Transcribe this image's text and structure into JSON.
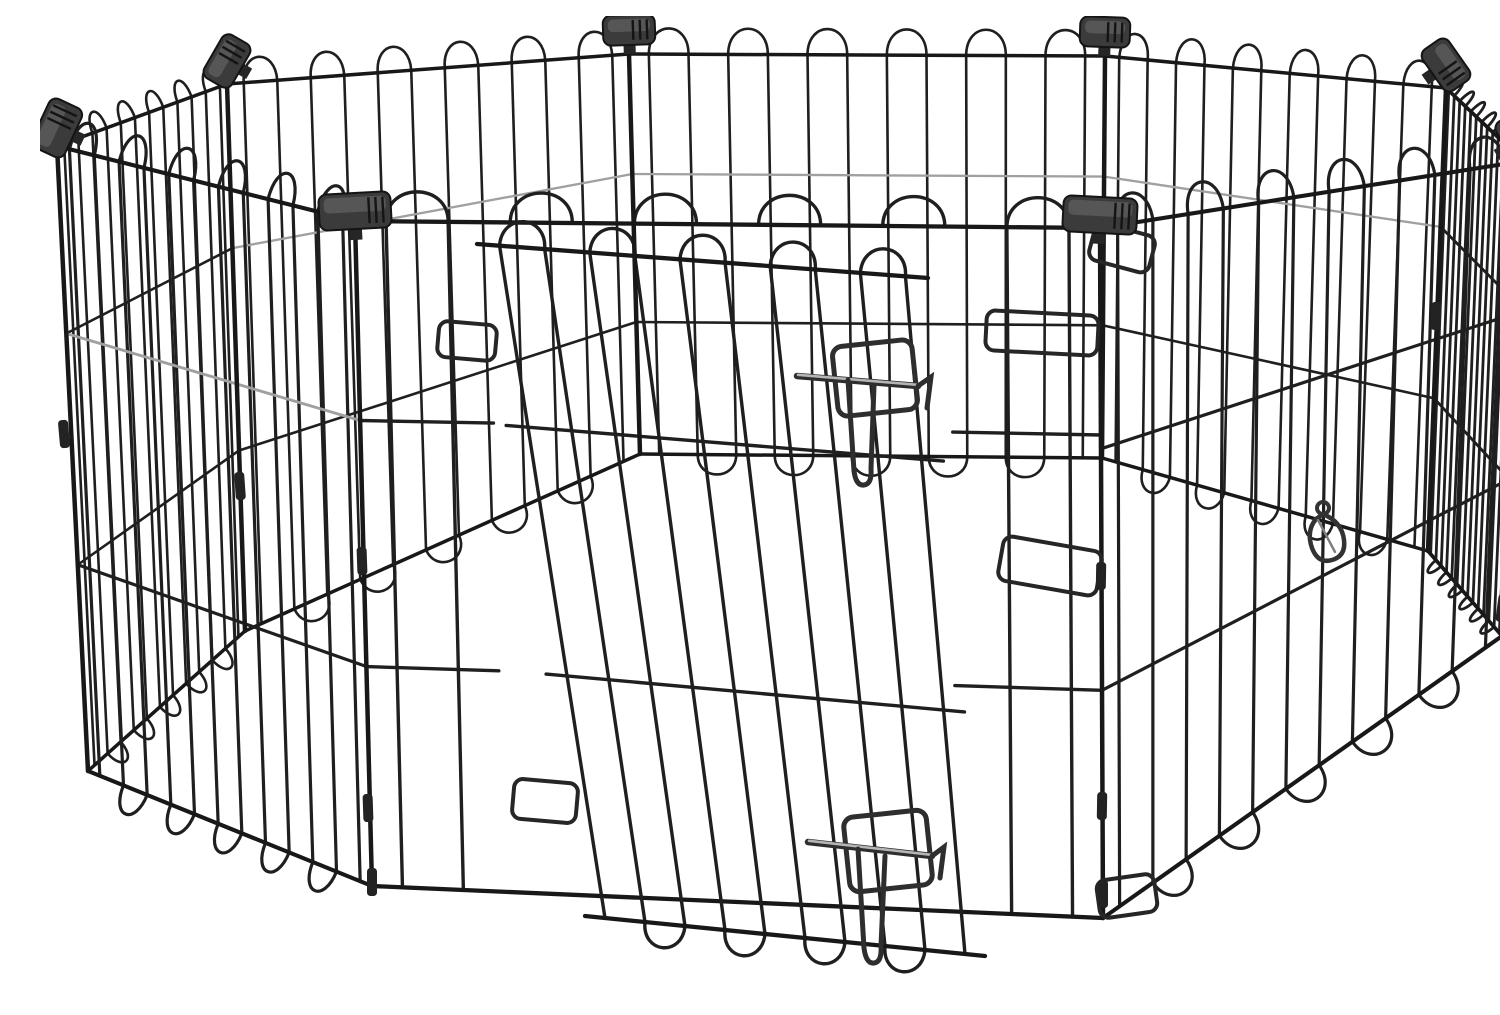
{
  "scene": {
    "subject": "black metal wire 8-panel octagonal pet exercise playpen with latched door",
    "background": "#ffffff",
    "canvas": {
      "width": 1500,
      "height": 983
    }
  },
  "palette": {
    "wire_dark": "#1f1f1f",
    "wire_frame": "#181818",
    "wire_light": "#a0a0a0",
    "latch_metal": "#2e2e2e",
    "latch_shine": "#b5b5b5",
    "connector_body": "#3b3b3b",
    "connector_face": "#5a5a5a",
    "connector_edge": "#141414",
    "clip_fill": "#232323"
  },
  "pen": {
    "panel_count": 8,
    "panels": [
      {
        "name": "back-center-panel",
        "quad": [
          [
            589,
            38
          ],
          [
            1065,
            40
          ],
          [
            1062,
            442
          ],
          [
            600,
            438
          ]
        ],
        "wires": 12,
        "arch": 26,
        "loop": 20,
        "stroke": 2.6,
        "h_wires": [
          {
            "t": 0.3,
            "tone": "light"
          },
          {
            "t": 0.67,
            "tone": "dark"
          }
        ]
      },
      {
        "name": "back-left-panel",
        "quad": [
          [
            187,
            68
          ],
          [
            589,
            38
          ],
          [
            600,
            438
          ],
          [
            205,
            615
          ]
        ],
        "wires": 12,
        "arch": 25,
        "loop": 20,
        "stroke": 2.6,
        "h_wires": [
          {
            "t": 0.3,
            "tone": "light"
          },
          {
            "t": 0.67,
            "tone": "dark"
          }
        ]
      },
      {
        "name": "back-right-panel",
        "quad": [
          [
            1065,
            40
          ],
          [
            1406,
            72
          ],
          [
            1388,
            535
          ],
          [
            1062,
            442
          ]
        ],
        "wires": 12,
        "arch": 25,
        "loop": 20,
        "stroke": 2.6,
        "h_wires": [
          {
            "t": 0.3,
            "tone": "light"
          },
          {
            "t": 0.67,
            "tone": "dark"
          }
        ]
      },
      {
        "name": "left-corner-panel",
        "quad": [
          [
            17,
            130
          ],
          [
            187,
            68
          ],
          [
            205,
            615
          ],
          [
            48,
            755
          ]
        ],
        "wires": 12,
        "arch": 20,
        "loop": 18,
        "stroke": 2.6,
        "h_wires": [
          {
            "t": 0.3,
            "tone": "dark"
          },
          {
            "t": 0.67,
            "tone": "dark"
          }
        ]
      },
      {
        "name": "right-corner-panel",
        "quad": [
          [
            1406,
            72
          ],
          [
            1483,
            145
          ],
          [
            1462,
            620
          ],
          [
            1388,
            535
          ]
        ],
        "wires": 14,
        "arch": 16,
        "loop": 14,
        "stroke": 2.8,
        "h_wires": [
          {
            "t": 0.3,
            "tone": "dark"
          },
          {
            "t": 0.67,
            "tone": "dark"
          }
        ]
      },
      {
        "name": "left-front-panel",
        "quad": [
          [
            17,
            130
          ],
          [
            315,
            205
          ],
          [
            332,
            870
          ],
          [
            48,
            755
          ]
        ],
        "wires": 12,
        "arch": 30,
        "loop": 26,
        "stroke": 3.2,
        "h_wires": [
          {
            "t": 0.3,
            "tone": "light"
          },
          {
            "t": 0.67,
            "tone": "dark"
          }
        ]
      },
      {
        "name": "right-front-panel",
        "quad": [
          [
            1060,
            212
          ],
          [
            1483,
            145
          ],
          [
            1462,
            620
          ],
          [
            1063,
            902
          ]
        ],
        "wires": 12,
        "arch": 30,
        "loop": 26,
        "stroke": 3.2,
        "h_wires": [
          {
            "t": 0.32,
            "tone": "dark"
          },
          {
            "t": 0.67,
            "tone": "dark"
          }
        ]
      },
      {
        "name": "front-door-panel",
        "quad": [
          [
            315,
            205
          ],
          [
            1060,
            212
          ],
          [
            1063,
            902
          ],
          [
            332,
            870
          ]
        ],
        "wires": 12,
        "arch": 30,
        "loop": 26,
        "stroke": 3.4,
        "sections": [
          [
            0,
            0.18
          ],
          [
            0.8,
            1
          ]
        ],
        "h_wires": [
          {
            "t": 0.3,
            "tone": "dark"
          },
          {
            "t": 0.67,
            "tone": "dark"
          }
        ]
      },
      {
        "name": "door-leaf",
        "quad": [
          [
            437,
            228
          ],
          [
            888,
            262
          ],
          [
            945,
            940
          ],
          [
            545,
            900
          ]
        ],
        "wires": 10,
        "arch": 26,
        "loop": 24,
        "stroke": 3.4,
        "h_wires": [
          {
            "t": 0.27,
            "tone": "dark"
          },
          {
            "t": 0.64,
            "tone": "dark"
          }
        ]
      }
    ],
    "rods": [
      {
        "name": "corner-rod-left-far",
        "from": [
          17,
          130
        ],
        "to": [
          48,
          755
        ]
      },
      {
        "name": "corner-rod-back-left",
        "from": [
          187,
          68
        ],
        "to": [
          205,
          615
        ]
      },
      {
        "name": "corner-rod-back-center-left",
        "from": [
          589,
          38
        ],
        "to": [
          600,
          438
        ]
      },
      {
        "name": "corner-rod-back-center-right",
        "from": [
          1065,
          40
        ],
        "to": [
          1062,
          442
        ]
      },
      {
        "name": "corner-rod-back-right",
        "from": [
          1406,
          72
        ],
        "to": [
          1388,
          535
        ]
      },
      {
        "name": "corner-rod-right-far",
        "from": [
          1483,
          145
        ],
        "to": [
          1462,
          620
        ]
      },
      {
        "name": "corner-rod-front-left",
        "from": [
          315,
          205
        ],
        "to": [
          332,
          870
        ]
      },
      {
        "name": "corner-rod-front-right",
        "from": [
          1060,
          212
        ],
        "to": [
          1063,
          902
        ]
      }
    ],
    "connectors": [
      {
        "name": "corner-connector",
        "x": 17,
        "y": 112,
        "angle": -65,
        "w": 54,
        "h": 36
      },
      {
        "name": "corner-connector",
        "x": 187,
        "y": 45,
        "angle": -60,
        "w": 50,
        "h": 32
      },
      {
        "name": "corner-connector",
        "x": 589,
        "y": 14,
        "angle": -2,
        "w": 52,
        "h": 30
      },
      {
        "name": "corner-connector",
        "x": 1065,
        "y": 16,
        "angle": 2,
        "w": 50,
        "h": 30
      },
      {
        "name": "corner-connector",
        "x": 1406,
        "y": 49,
        "angle": 55,
        "w": 50,
        "h": 32
      },
      {
        "name": "corner-connector",
        "x": 1483,
        "y": 124,
        "angle": 60,
        "w": 56,
        "h": 38
      },
      {
        "name": "corner-connector",
        "x": 315,
        "y": 195,
        "angle": -3,
        "w": 72,
        "h": 36
      },
      {
        "name": "corner-connector",
        "x": 1060,
        "y": 199,
        "angle": 3,
        "w": 74,
        "h": 36
      }
    ],
    "clips": [
      [
        24,
        418,
        -5
      ],
      [
        200,
        470,
        -4
      ],
      [
        322,
        545,
        -2
      ],
      [
        328,
        792,
        -2
      ],
      [
        332,
        866,
        0
      ],
      [
        1061,
        560,
        1
      ],
      [
        1062,
        790,
        1
      ],
      [
        1396,
        300,
        3
      ],
      [
        1470,
        370,
        10
      ],
      [
        1462,
        592,
        8
      ],
      [
        1063,
        878,
        0
      ]
    ],
    "keeper_loops": [
      [
        427,
        325,
        58,
        36,
        5
      ],
      [
        505,
        785,
        64,
        40,
        5
      ],
      [
        1002,
        317,
        112,
        40,
        3
      ],
      [
        1010,
        550,
        100,
        45,
        10
      ],
      [
        1082,
        232,
        62,
        38,
        15
      ],
      [
        1087,
        880,
        58,
        38,
        -8
      ]
    ],
    "latches": [
      {
        "name": "door-latch-upper",
        "frame": [
          835,
          362,
          80,
          70,
          -6
        ],
        "bolt": [
          757,
          360,
          878,
          370
        ],
        "hook": "M 878 370 L 891 361 L 887 392",
        "handle": "M 808 364 L 814 455 Q 816 470 824 469 Q 832 468 831 453 L 834 370"
      },
      {
        "name": "door-latch-lower",
        "frame": [
          848,
          835,
          83,
          75,
          -6
        ],
        "bolt": [
          768,
          826,
          892,
          840
        ],
        "hook": "M 892 840 L 904 831 L 900 862",
        "handle": "M 818 833 L 824 932 Q 826 948 834 947 Q 842 946 841 930 L 845 840"
      }
    ],
    "carabiner": {
      "name": "snap-hook",
      "ring": [
        1283,
        492,
        6
      ],
      "body": "M 1283 498 Q 1302 506 1304 524 Q 1306 540 1292 544 Q 1278 548 1272 532 Q 1266 515 1276 503 Z",
      "gate": [
        1278,
        504,
        1295,
        536
      ]
    }
  }
}
